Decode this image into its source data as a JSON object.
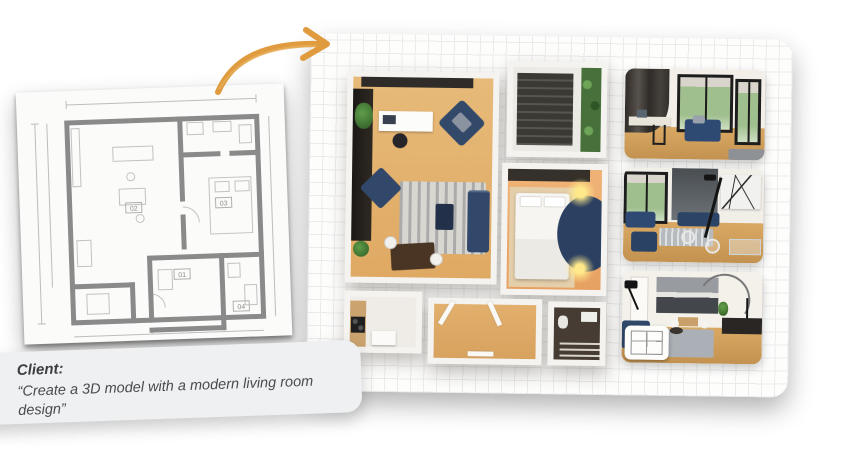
{
  "canvas": {
    "width": 843,
    "height": 450,
    "background": "#ffffff"
  },
  "client_note": {
    "label": "Client:",
    "quote": "“Create a 3D model with a modern living room design”"
  },
  "blueprint": {
    "kind": "2d-architectural-floor-plan",
    "room_labels": {
      "living": "02",
      "bedroom": "03",
      "hall": "01",
      "bath": "04"
    }
  },
  "board": {
    "kind": "grid-paper-panel",
    "model": "3d-isometric-floor-plan",
    "renders": [
      {
        "name": "workspace-window-render"
      },
      {
        "name": "modern-living-room-render"
      },
      {
        "name": "living-kitchen-render"
      }
    ]
  },
  "icons": {
    "arrow": "hand-drawn-curved-arrow"
  },
  "colors": {
    "arrow_orange": "#df9b3e",
    "navy_furniture": "#31486b",
    "wood_floor": "#e2b072",
    "bedroom_floor": "#eca96b",
    "grid_line": "#ebebeb",
    "panel_white": "#fdfdfc",
    "wall_white": "#f4f3f0",
    "dark_feature_wall": "#26211c",
    "plant_green": "#4a7a3a",
    "note_card_gray": "#eef0f1",
    "text_dark": "#3e3e40"
  }
}
